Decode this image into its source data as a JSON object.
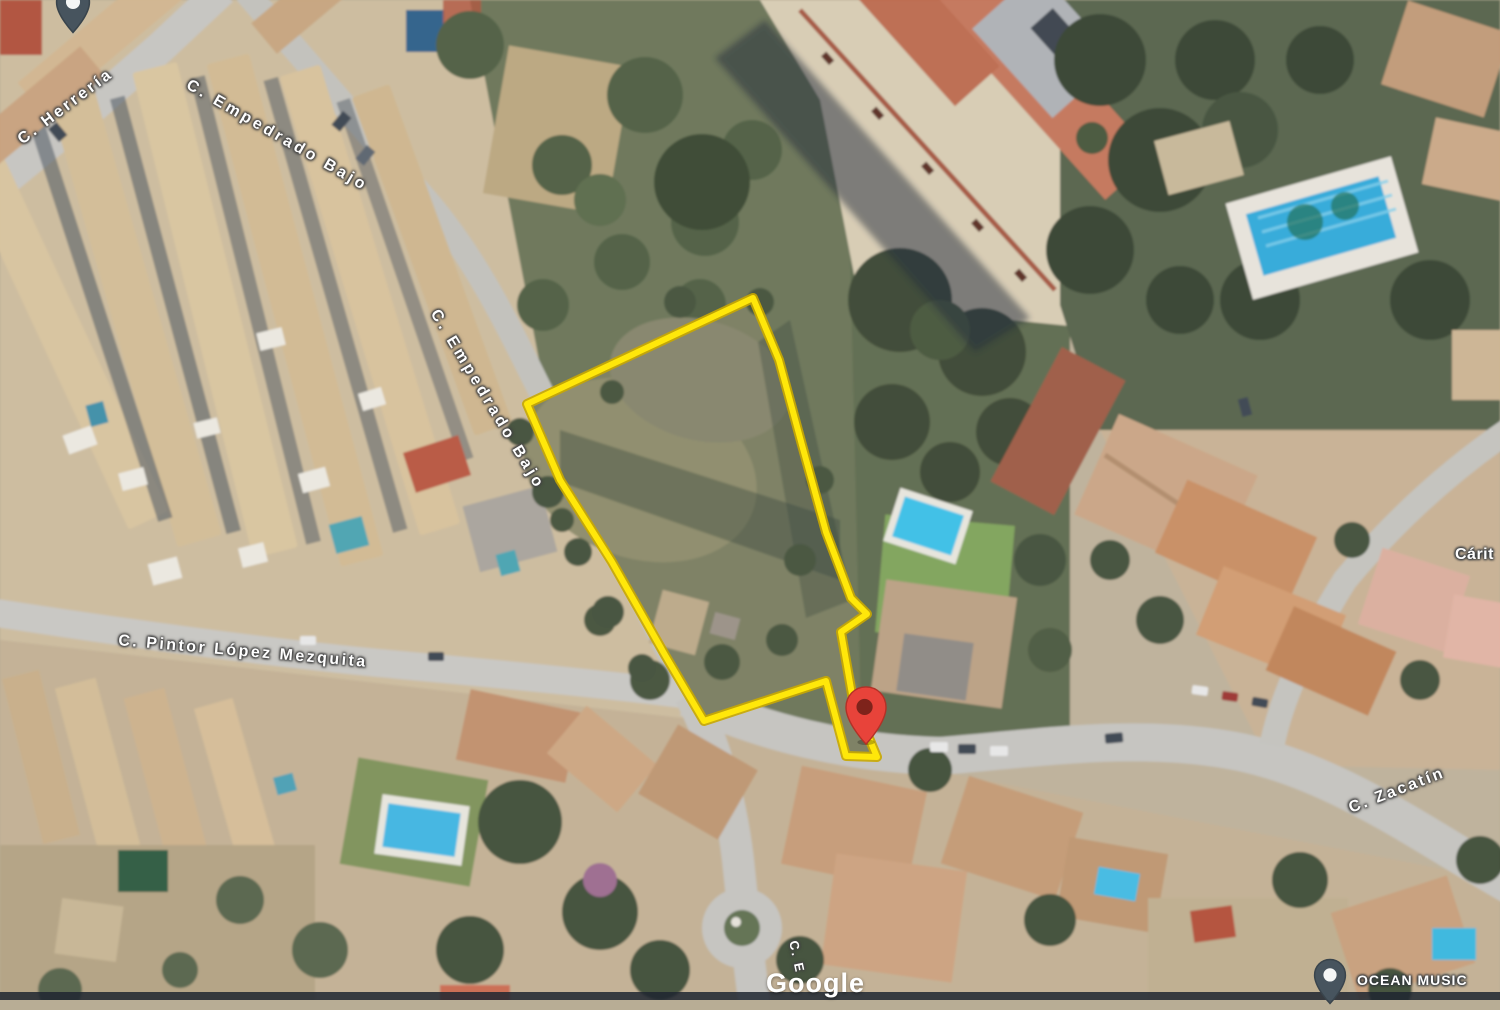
{
  "map": {
    "view_type": "satellite",
    "watermark": "Google",
    "street_labels": [
      {
        "text": "C. Herrería"
      },
      {
        "text": "C. Empedrado Bajo"
      },
      {
        "text": "C. Empedrado Bajo"
      },
      {
        "text": "C. Pintor López Mezquita"
      },
      {
        "text": "C. Zacatín"
      },
      {
        "text": "C. E"
      }
    ],
    "poi_labels": [
      {
        "text": "Cárit"
      },
      {
        "text": "OCEAN MUSIC"
      }
    ],
    "parcel": {
      "outline_color": "#FFE70A",
      "outline_undercolor": "#C9A800",
      "points_svg": "753,298 779,360 802,445 826,532 851,598 867,614 841,632 853,700 877,757 846,756 826,681 704,721 665,655 612,562 560,480 527,404"
    },
    "markers": {
      "selected_location_color": "#E8433A",
      "poi_marker_color": "#47545E"
    }
  }
}
